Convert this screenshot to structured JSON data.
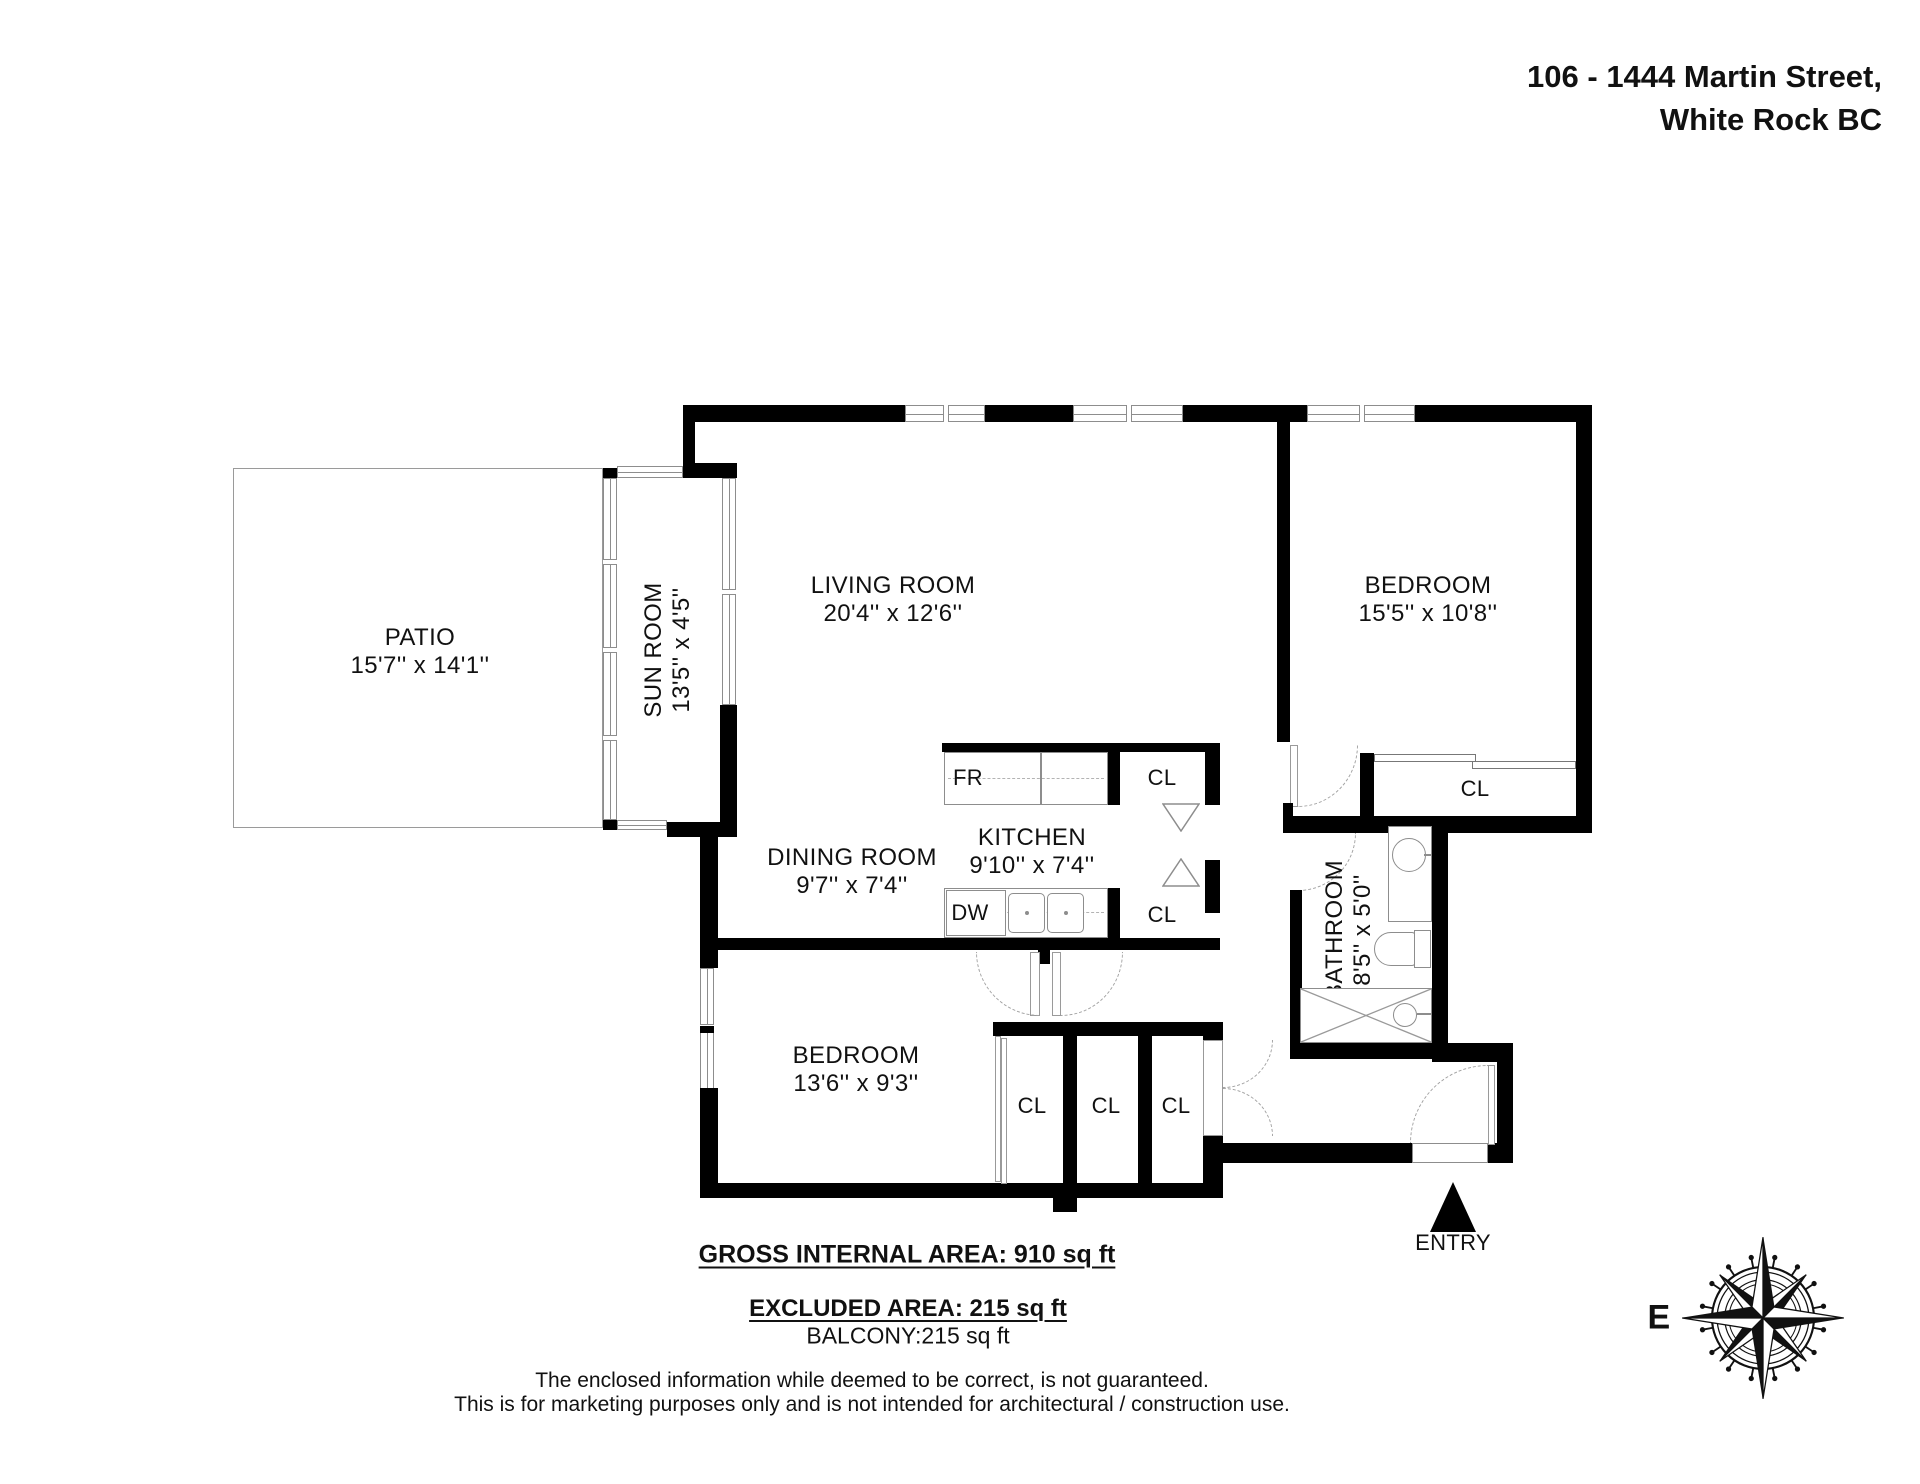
{
  "header": {
    "address_line1": "106 - 1444 Martin Street,",
    "address_line2": "White Rock BC"
  },
  "rooms": {
    "patio": {
      "name": "PATIO",
      "dims": "15'7'' x 14'1''"
    },
    "sun_room": {
      "name": "SUN ROOM",
      "dims": "13'5'' x 4'5''"
    },
    "living_room": {
      "name": "LIVING ROOM",
      "dims": "20'4'' x 12'6''"
    },
    "bedroom_primary": {
      "name": "BEDROOM",
      "dims": "15'5'' x 10'8''"
    },
    "dining_room": {
      "name": "DINING ROOM",
      "dims": "9'7'' x 7'4''"
    },
    "kitchen": {
      "name": "KITCHEN",
      "dims": "9'10'' x 7'4''"
    },
    "bathroom": {
      "name": "BATHROOM",
      "dims": "8'5'' x 5'0''"
    },
    "bedroom_second": {
      "name": "BEDROOM",
      "dims": "13'6'' x 9'3''"
    }
  },
  "fixtures": {
    "fridge": "FR",
    "dishwasher": "DW"
  },
  "closets": {
    "kitchen_top": "CL",
    "kitchen_bottom": "CL",
    "bedroom_primary": "CL",
    "hall": [
      "CL",
      "CL",
      "CL"
    ]
  },
  "entry": {
    "label": "ENTRY"
  },
  "compass": {
    "east_label": "E"
  },
  "areas": {
    "gross": "GROSS INTERNAL AREA: 910 sq ft",
    "excluded": "EXCLUDED AREA: 215 sq ft",
    "balcony": "BALCONY:215 sq ft"
  },
  "disclaimer": {
    "line1": "The enclosed information while deemed to be correct, is not guaranteed.",
    "line2": "This is for marketing purposes only and is not intended for architectural / construction use."
  },
  "colors": {
    "wall": "#000000",
    "text": "#111111",
    "window_line": "#8d8d8d",
    "door_arc": "#a3a3a3"
  }
}
